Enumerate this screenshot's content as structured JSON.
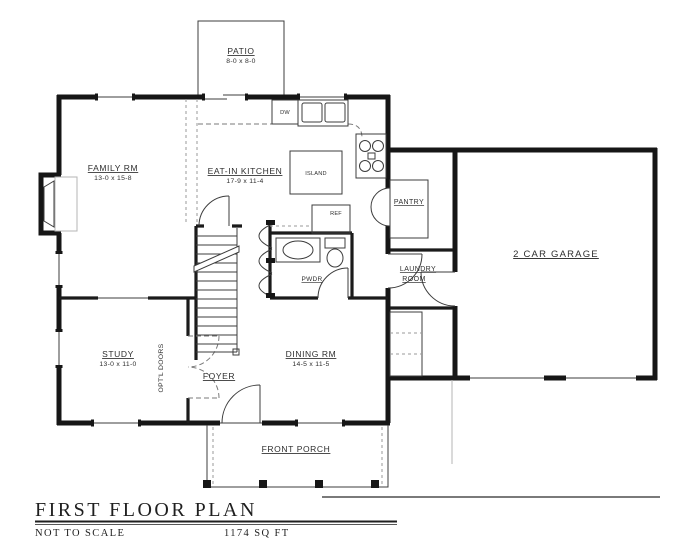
{
  "drawing": {
    "title": "FIRST FLOOR PLAN",
    "scale_note": "NOT TO SCALE",
    "area": "1174 SQ FT"
  },
  "rooms": {
    "patio": {
      "name": "PATIO",
      "dims": "8-0 x 8-0"
    },
    "family": {
      "name": "FAMILY RM",
      "dims": "13-0 x 15-8"
    },
    "kitchen": {
      "name": "EAT-IN KITCHEN",
      "dims": "17-9 x 11-4"
    },
    "study": {
      "name": "STUDY",
      "dims": "13-0 x 11-0"
    },
    "dining": {
      "name": "DINING RM",
      "dims": "14-5 x 11-5"
    },
    "garage": {
      "name": "2 CAR GARAGE"
    },
    "laundry": {
      "name_line1": "LAUNDRY",
      "name_line2": "ROOM"
    },
    "pantry": {
      "name": "PANTRY"
    },
    "powder": {
      "name": "PWDR"
    },
    "foyer": {
      "name": "FOYER"
    },
    "porch": {
      "name": "FRONT PORCH"
    }
  },
  "fixtures": {
    "island": "ISLAND",
    "refrigerator": "REF",
    "dishwasher": "DW",
    "optional_doors": "OPT'L DOORS"
  },
  "colors": {
    "wall": "#161616",
    "thin_line": "#3c3c3c",
    "dashed_line": "#7a7a7a",
    "background": "#ffffff"
  }
}
